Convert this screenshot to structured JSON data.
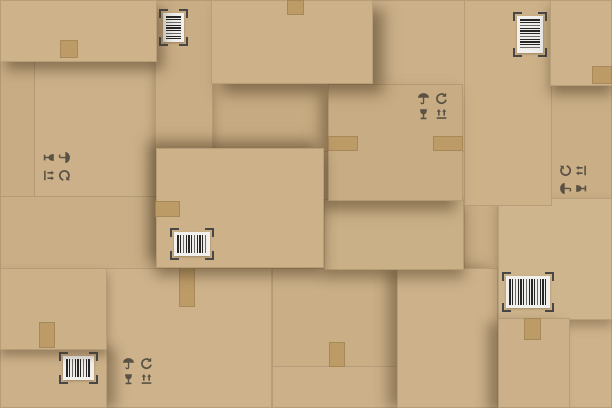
{
  "meta": {
    "description": "Flat-lay collage of overlapping brown cardboard shipping boxes with packing tape, barcode stickers and packaging symbols",
    "canvas": {
      "width": 612,
      "height": 408
    }
  },
  "palette": {
    "background": "#c9ae86",
    "cardboard_base": "#cbb089",
    "tape": "#bb9a64",
    "symbol_ink": "#5a5244",
    "label_bg": "#f1f0ed",
    "bar_dark": "#262626",
    "corner_bracket": "#474747",
    "shadow": "rgba(74,56,32,0.5)"
  },
  "scene": {
    "boxes": [
      {
        "name": "box-top-left",
        "x": 0,
        "y": 0,
        "w": 157,
        "h": 62,
        "shade": "#cdb28a",
        "z": 30,
        "shadow": "6px 8px 12px rgba(74,56,32,.5)"
      },
      {
        "name": "box-top-strip",
        "x": 155,
        "y": 0,
        "w": 58,
        "h": 150,
        "shade": "#c9ad85",
        "z": 14,
        "shadow": "0 6px 10px rgba(74,56,32,.35)"
      },
      {
        "name": "box-top-center",
        "x": 211,
        "y": 0,
        "w": 162,
        "h": 84,
        "shade": "#ccb189",
        "z": 28,
        "shadow": "10px 9px 14px rgba(74,56,32,.55)"
      },
      {
        "name": "box-under-top-center",
        "x": 211,
        "y": 82,
        "w": 121,
        "h": 70,
        "shade": "#c7ab82",
        "z": 4,
        "shadow": "none"
      },
      {
        "name": "box-top-mid-right",
        "x": 369,
        "y": 0,
        "w": 98,
        "h": 152,
        "shade": "#cbb089",
        "z": 3,
        "shadow": "none"
      },
      {
        "name": "box-right-column",
        "x": 464,
        "y": 0,
        "w": 88,
        "h": 206,
        "shade": "#ccb189",
        "z": 12,
        "shadow": "none"
      },
      {
        "name": "box-top-right",
        "x": 550,
        "y": 0,
        "w": 62,
        "h": 86,
        "shade": "#cdb28b",
        "z": 26,
        "shadow": "0 8px 12px rgba(74,56,32,.5)"
      },
      {
        "name": "box-right-mid",
        "x": 550,
        "y": 84,
        "w": 62,
        "h": 116,
        "shade": "#c9ae86",
        "z": 5,
        "shadow": "none"
      },
      {
        "name": "box-left-narrow",
        "x": 0,
        "y": 60,
        "w": 35,
        "h": 138,
        "shade": "#c8ac84",
        "z": 6,
        "shadow": "none"
      },
      {
        "name": "box-left-symbols",
        "x": 33,
        "y": 60,
        "w": 126,
        "h": 138,
        "shade": "#cbb089",
        "z": 5,
        "shadow": "none"
      },
      {
        "name": "box-left-mid",
        "x": 0,
        "y": 196,
        "w": 159,
        "h": 74,
        "shade": "#c9ae86",
        "z": 7,
        "shadow": "none"
      },
      {
        "name": "box-left-lower",
        "x": 0,
        "y": 268,
        "w": 107,
        "h": 82,
        "shade": "#ccb088",
        "z": 18,
        "shadow": "0 6px 9px rgba(74,56,32,.4)"
      },
      {
        "name": "box-bottom-left",
        "x": 0,
        "y": 348,
        "w": 107,
        "h": 60,
        "shade": "#cbb089",
        "z": 16,
        "shadow": "8px 0 12px rgba(74,56,32,.45)"
      },
      {
        "name": "box-bottom-left-wide",
        "x": 105,
        "y": 268,
        "w": 167,
        "h": 140,
        "shade": "#cdb28b",
        "z": 8,
        "shadow": "none"
      },
      {
        "name": "box-center",
        "x": 156,
        "y": 148,
        "w": 168,
        "h": 120,
        "shade": "#ccb189",
        "z": 24,
        "shadow": "-8px -7px 13px rgba(74,56,32,.5), 0 8px 12px rgba(74,56,32,.45)"
      },
      {
        "name": "box-center-symbols",
        "x": 328,
        "y": 84,
        "w": 135,
        "h": 117,
        "shade": "#c8ac83",
        "z": 22,
        "shadow": "-7px 9px 13px rgba(74,56,32,.5)"
      },
      {
        "name": "box-center-lower",
        "x": 324,
        "y": 199,
        "w": 140,
        "h": 71,
        "shade": "#cab086",
        "z": 10,
        "shadow": "0 8px 12px rgba(74,56,32,.45)"
      },
      {
        "name": "box-bottom-center",
        "x": 272,
        "y": 268,
        "w": 128,
        "h": 100,
        "shade": "#c9ae86",
        "z": 2,
        "shadow": "none"
      },
      {
        "name": "box-bottom-center-low",
        "x": 272,
        "y": 366,
        "w": 128,
        "h": 42,
        "shade": "#cbb089",
        "z": 2,
        "shadow": "none"
      },
      {
        "name": "box-bottom-mid-right",
        "x": 397,
        "y": 268,
        "w": 101,
        "h": 140,
        "shade": "#ccb18a",
        "z": 9,
        "shadow": "-9px 0 13px rgba(74,56,32,.45)"
      },
      {
        "name": "box-right-lower",
        "x": 498,
        "y": 198,
        "w": 114,
        "h": 122,
        "shade": "#cfb58d",
        "z": 11,
        "shadow": "0 6px 10px rgba(74,56,32,.35)"
      },
      {
        "name": "box-right-col-low",
        "x": 464,
        "y": 204,
        "w": 36,
        "h": 204,
        "shade": "#c9ad85",
        "z": 6,
        "shadow": "none"
      },
      {
        "name": "box-bottom-right-a",
        "x": 498,
        "y": 318,
        "w": 72,
        "h": 90,
        "shade": "#cbb089",
        "z": 13,
        "shadow": "-10px 5px 12px rgba(74,56,32,.45)"
      },
      {
        "name": "box-bottom-right-b",
        "x": 568,
        "y": 318,
        "w": 44,
        "h": 90,
        "shade": "#cdb28b",
        "z": 7,
        "shadow": "none"
      }
    ],
    "tapes": [
      {
        "x": 60,
        "y": 40,
        "w": 18,
        "h": 18,
        "z": 31
      },
      {
        "x": 287,
        "y": 0,
        "w": 17,
        "h": 15,
        "z": 29
      },
      {
        "x": 592,
        "y": 66,
        "w": 20,
        "h": 18,
        "z": 27
      },
      {
        "x": 155,
        "y": 201,
        "w": 25,
        "h": 16,
        "z": 25
      },
      {
        "x": 328,
        "y": 136,
        "w": 30,
        "h": 15,
        "z": 23
      },
      {
        "x": 433,
        "y": 136,
        "w": 30,
        "h": 15,
        "z": 23
      },
      {
        "x": 179,
        "y": 263,
        "w": 16,
        "h": 44,
        "z": 9
      },
      {
        "x": 39,
        "y": 322,
        "w": 16,
        "h": 26,
        "z": 19
      },
      {
        "x": 329,
        "y": 342,
        "w": 16,
        "h": 25,
        "z": 3
      },
      {
        "x": 524,
        "y": 318,
        "w": 17,
        "h": 22,
        "z": 14
      }
    ],
    "barcodes": [
      {
        "x": 163,
        "y": 13,
        "w": 21,
        "h": 29,
        "orientation": "rotated",
        "z": 15
      },
      {
        "x": 517,
        "y": 16,
        "w": 26,
        "h": 37,
        "orientation": "rotated",
        "z": 13
      },
      {
        "x": 174,
        "y": 232,
        "w": 36,
        "h": 24,
        "orientation": "horizontal",
        "z": 25
      },
      {
        "x": 506,
        "y": 276,
        "w": 44,
        "h": 32,
        "orientation": "horizontal",
        "z": 12
      },
      {
        "x": 63,
        "y": 356,
        "w": 31,
        "h": 24,
        "orientation": "horizontal",
        "z": 17
      }
    ],
    "symbol_groups": [
      {
        "x": 41,
        "y": 152,
        "rotation": 90,
        "z": 7,
        "icons": [
          "keep-dry",
          "recycle",
          "fragile",
          "this-way-up"
        ]
      },
      {
        "x": 417,
        "y": 92,
        "rotation": 0,
        "z": 23,
        "icons": [
          "keep-dry",
          "recycle",
          "fragile",
          "this-way-up"
        ]
      },
      {
        "x": 122,
        "y": 357,
        "rotation": 0,
        "z": 9,
        "icons": [
          "keep-dry",
          "recycle",
          "fragile",
          "this-way-up"
        ]
      },
      {
        "x": 558,
        "y": 165,
        "rotation": -90,
        "z": 6,
        "icons": [
          "keep-dry",
          "recycle",
          "fragile",
          "this-way-up"
        ]
      }
    ]
  }
}
